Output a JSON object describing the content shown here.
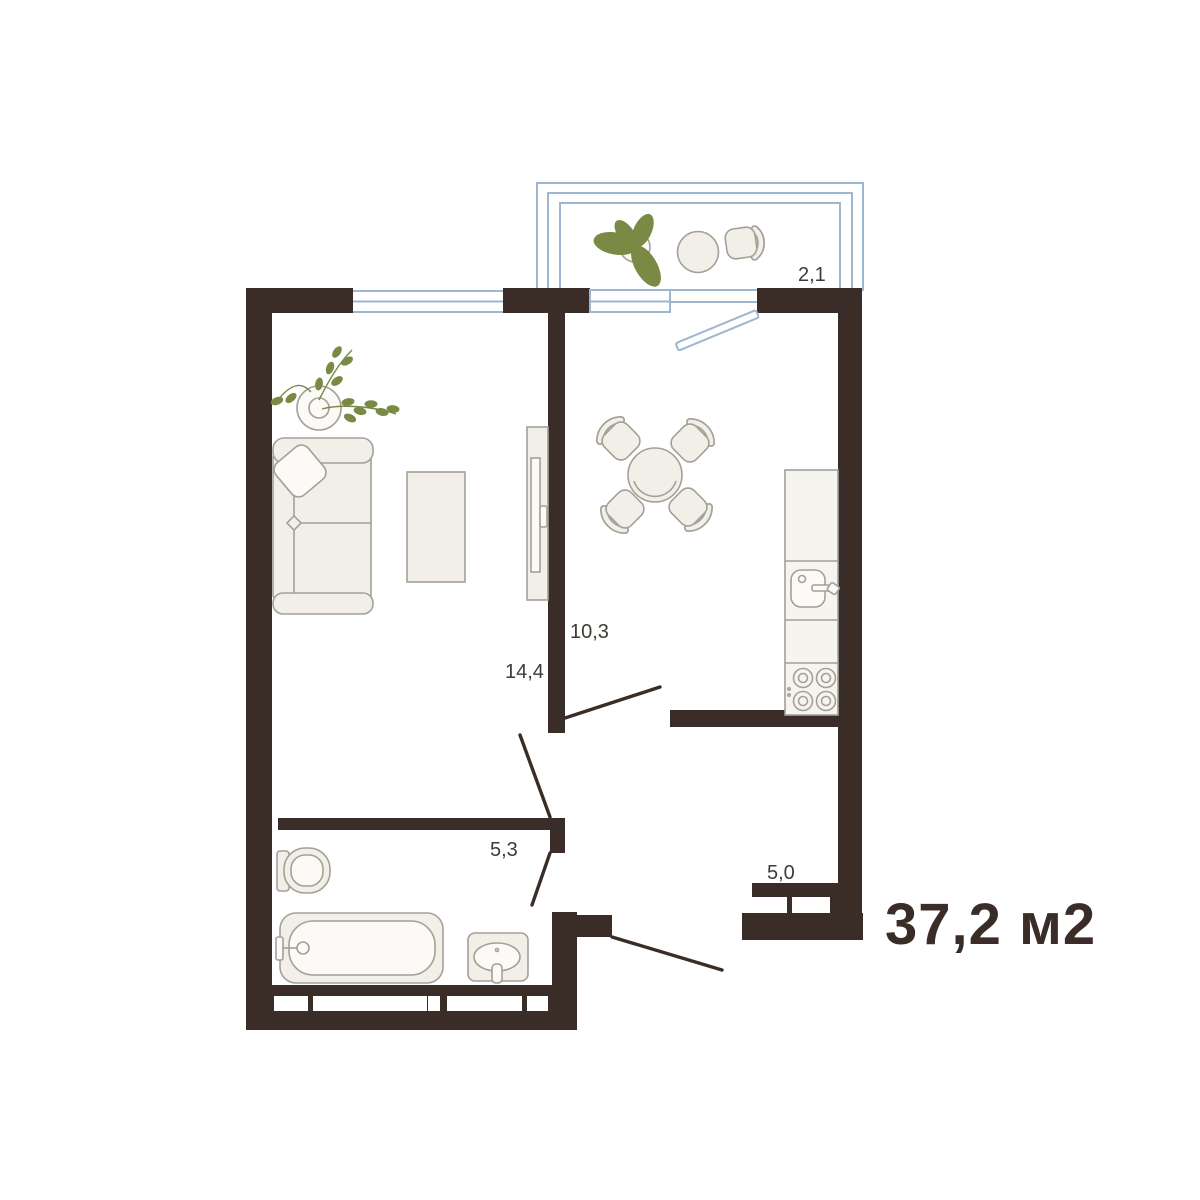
{
  "plan": {
    "total_area": "37,2 м2",
    "rooms": [
      {
        "name": "living-room",
        "area": "14,4"
      },
      {
        "name": "kitchen",
        "area": "10,3"
      },
      {
        "name": "bathroom",
        "area": "5,3"
      },
      {
        "name": "hallway",
        "area": "5,0"
      },
      {
        "name": "balcony",
        "area": "2,1"
      }
    ],
    "colors": {
      "wall": "#3A2D27",
      "window": "#9FB6D0",
      "furnFill": "#F2EFE8",
      "furnLine": "#A3A098",
      "liteFill": "#FBFAF6",
      "counterFill": "#F6F4EE",
      "plant": "#7A8A45",
      "text": "#3F3B35"
    }
  }
}
